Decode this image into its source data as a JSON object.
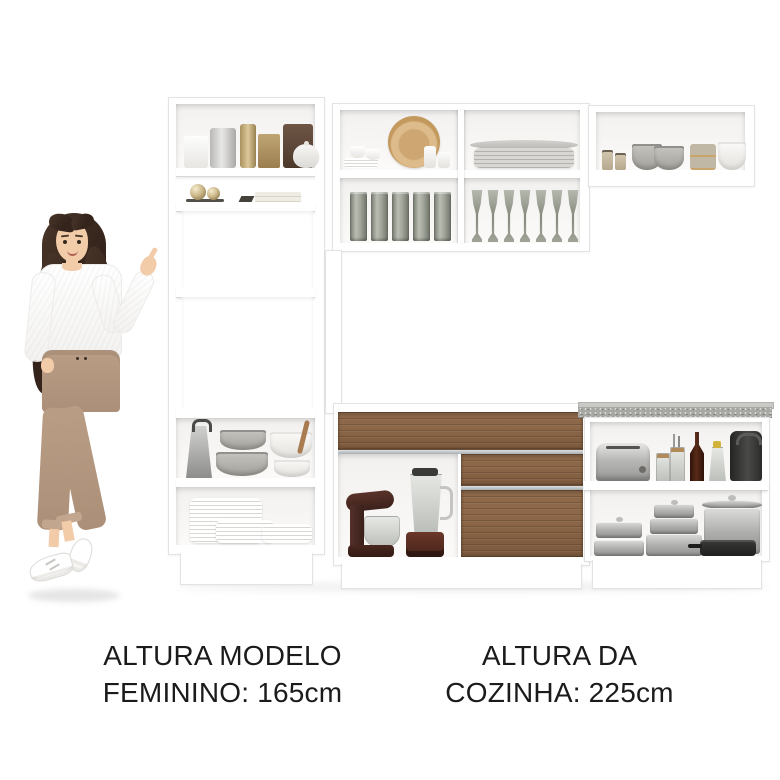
{
  "captions": {
    "model_height": {
      "line1": "ALTURA MODELO",
      "line2": "FEMININO: 165cm"
    },
    "kitchen_height": {
      "line1": "ALTURA DA",
      "line2": "COZINHA: 225cm"
    }
  },
  "palette": {
    "background": "#ffffff",
    "cabinet_white": "#ffffff",
    "wood_drawer": "#8d6849",
    "countertop_gray": "#a7a7a3",
    "text_black": "#1b1b1b",
    "pants_tan": "#b99d85",
    "hair_brown": "#34241b"
  }
}
